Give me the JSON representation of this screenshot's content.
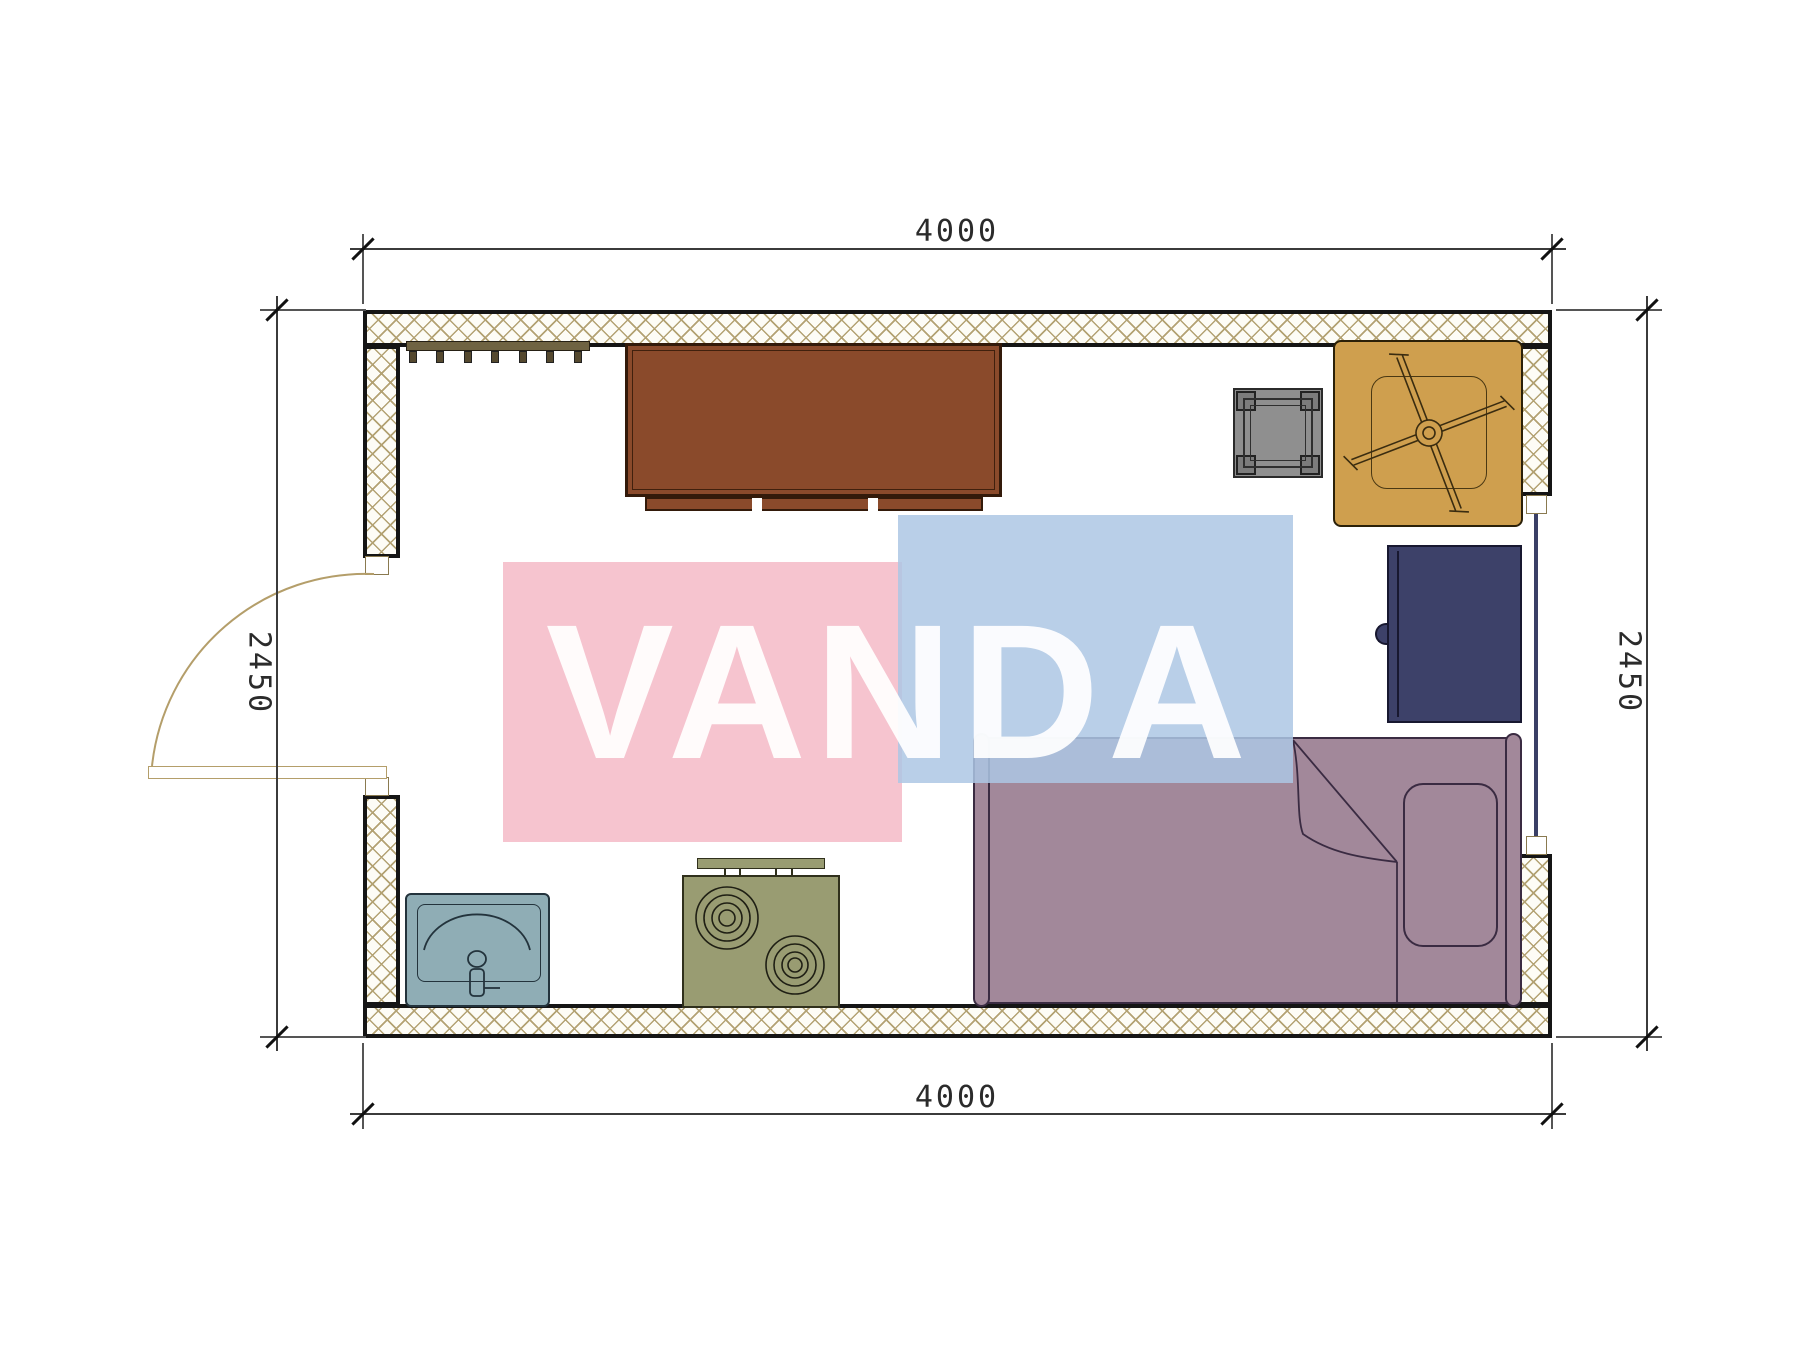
{
  "drawing": {
    "type": "floor-plan",
    "room_width_mm": "4000",
    "room_depth_mm": "2450"
  },
  "dimensions": {
    "top": "4000",
    "bottom": "4000",
    "left": "2450",
    "right": "2450"
  },
  "watermark": {
    "text": "VANDA",
    "pink_color": "#f4bac7",
    "blue_color": "#adc7e4",
    "text_color": "#ffffff"
  },
  "walls": {
    "hatch_color": "#b3a273",
    "outline_color": "#151515"
  },
  "furniture": [
    {
      "name": "coat-rack",
      "color": "#6f6342"
    },
    {
      "name": "cabinet",
      "color": "#8a4a2b"
    },
    {
      "name": "stool",
      "color": "#8f8f8f"
    },
    {
      "name": "table-with-swivel-chair",
      "color": "#cf9f4e"
    },
    {
      "name": "wardrobe",
      "color": "#3d4169"
    },
    {
      "name": "bed",
      "color": "#a2889a"
    },
    {
      "name": "sink",
      "color": "#8fadb5"
    },
    {
      "name": "stove",
      "color": "#999c72"
    }
  ],
  "openings": [
    {
      "name": "door",
      "wall": "left",
      "swing": "outward"
    },
    {
      "name": "window",
      "wall": "right",
      "glass_color": "#3a3f66"
    }
  ]
}
